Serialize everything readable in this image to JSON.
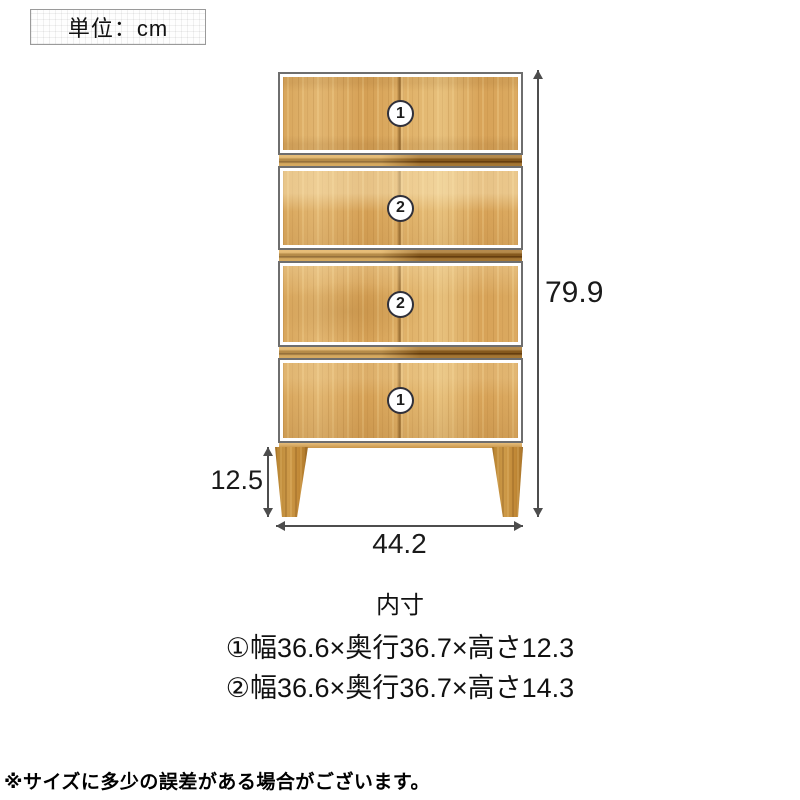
{
  "unit_box": {
    "label": "単位：cm"
  },
  "diagram": {
    "type": "furniture-dimension-diagram",
    "drawers": [
      {
        "number": "1"
      },
      {
        "number": "2"
      },
      {
        "number": "2"
      },
      {
        "number": "1"
      }
    ],
    "dimensions": {
      "height": "79.9",
      "leg_height": "12.5",
      "width": "44.2"
    }
  },
  "inner_dimensions": {
    "title": "内寸",
    "lines": [
      "①幅36.6×奥行36.7×高さ12.3",
      "②幅36.6×奥行36.7×高さ14.3"
    ]
  },
  "footnote": "※サイズに多少の誤差がある場合がございます。",
  "colors": {
    "wood_base": "#dcab62",
    "wood_dark": "#9a6a26",
    "leg": "#c18836",
    "dimension_line": "#4d4d4d",
    "text": "#111111"
  }
}
